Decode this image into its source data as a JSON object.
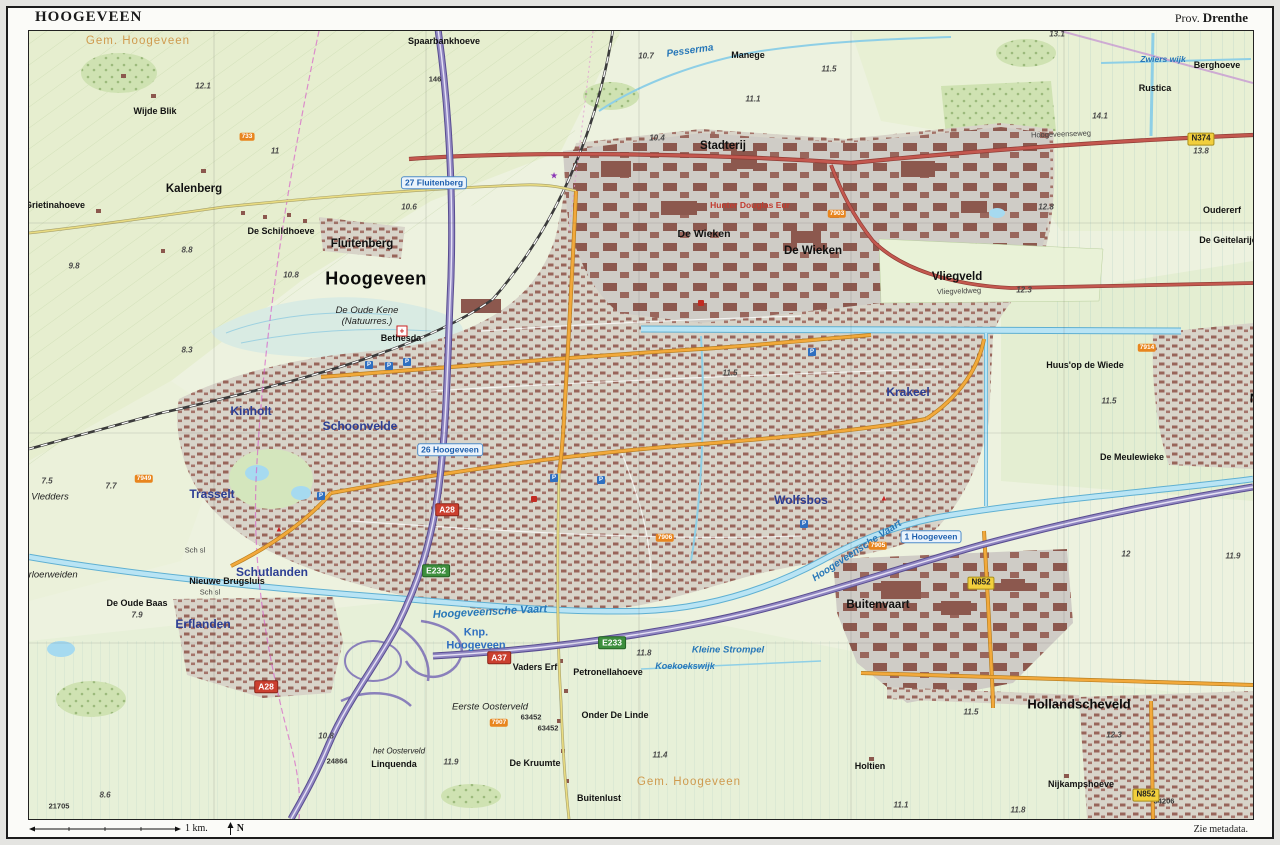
{
  "header": {
    "title": "HOOGEVEEN",
    "province_prefix": "Prov.",
    "province": "Drenthe"
  },
  "footer": {
    "scale_label": "1 km.",
    "north_label": "N",
    "metadata_note": "Zie metadata."
  },
  "palette": {
    "field_green": "#edf2df",
    "forest_green": "#cfe2b2",
    "urban_base": "#d8d4c9",
    "building_red": "#98655a",
    "motorway_purple": "#9187c2",
    "main_road_red": "#c4584f",
    "city_road_orange": "#f2a93b",
    "water_blue": "#b9e4f4",
    "district_blue": "#2c3e94",
    "municipality_orange": "#cf9a4e"
  },
  "map": {
    "labels": [
      {
        "text": "Gem. Hoogeveen",
        "type": "muni",
        "x": 137,
        "y": 40
      },
      {
        "text": "Gem. Hoogeveen",
        "type": "muni",
        "x": 688,
        "y": 781
      },
      {
        "text": "Hoogeveen",
        "type": "major",
        "x": 375,
        "y": 278,
        "name": "map-label-hoogeveen-city"
      },
      {
        "text": "Hollandscheveld",
        "type": "city2",
        "x": 1078,
        "y": 703
      },
      {
        "text": "Noordscheschut",
        "type": "city2",
        "x": 1300,
        "y": 397
      },
      {
        "text": "Fluitenberg",
        "type": "town",
        "x": 361,
        "y": 243
      },
      {
        "text": "Kalenberg",
        "type": "town",
        "x": 193,
        "y": 188
      },
      {
        "text": "Stadterij",
        "type": "town",
        "x": 722,
        "y": 145
      },
      {
        "text": "De Wieken",
        "type": "town",
        "x": 703,
        "y": 233,
        "size": 10.5
      },
      {
        "text": "De Wieken",
        "type": "town",
        "x": 812,
        "y": 250
      },
      {
        "text": "Vliegveld",
        "type": "town",
        "x": 956,
        "y": 276
      },
      {
        "text": "Buitenvaart",
        "type": "town",
        "x": 877,
        "y": 604
      },
      {
        "text": "Wijde Blik",
        "type": "hamlet",
        "x": 154,
        "y": 110
      },
      {
        "text": "Grietinahoeve",
        "type": "hamlet",
        "x": 54,
        "y": 204
      },
      {
        "text": "De Schildhoeve",
        "type": "hamlet",
        "x": 280,
        "y": 230
      },
      {
        "text": "Spaarbankhoeve",
        "type": "hamlet",
        "x": 443,
        "y": 40
      },
      {
        "text": "Manege",
        "type": "hamlet",
        "x": 747,
        "y": 54
      },
      {
        "text": "Berghoeve",
        "type": "hamlet",
        "x": 1216,
        "y": 64
      },
      {
        "text": "Rustica",
        "type": "hamlet",
        "x": 1154,
        "y": 87
      },
      {
        "text": "Oudererf",
        "type": "hamlet",
        "x": 1221,
        "y": 209
      },
      {
        "text": "De Geitelarije",
        "type": "hamlet",
        "x": 1227,
        "y": 239
      },
      {
        "text": "Huus'op de Wiede",
        "type": "hamlet",
        "x": 1084,
        "y": 364
      },
      {
        "text": "De Meulewieke",
        "type": "hamlet",
        "x": 1131,
        "y": 456
      },
      {
        "text": "Nieuwe Brugsluis",
        "type": "hamlet",
        "x": 226,
        "y": 580
      },
      {
        "text": "De Oude Baas",
        "type": "hamlet",
        "x": 136,
        "y": 602
      },
      {
        "text": "Vaders Erf",
        "type": "hamlet",
        "x": 534,
        "y": 666
      },
      {
        "text": "Petronellahoeve",
        "type": "hamlet",
        "x": 607,
        "y": 671
      },
      {
        "text": "Onder De Linde",
        "type": "hamlet",
        "x": 614,
        "y": 714
      },
      {
        "text": "De Kruumte",
        "type": "hamlet",
        "x": 534,
        "y": 762
      },
      {
        "text": "Linquenda",
        "type": "hamlet",
        "x": 393,
        "y": 763
      },
      {
        "text": "Buitenlust",
        "type": "hamlet",
        "x": 598,
        "y": 797
      },
      {
        "text": "Nijkampshoeve",
        "type": "hamlet",
        "x": 1080,
        "y": 783
      },
      {
        "text": "Holtien",
        "type": "hamlet",
        "x": 869,
        "y": 765
      },
      {
        "text": "Bethesda",
        "type": "hamlet",
        "x": 400,
        "y": 337
      },
      {
        "text": "Hunter Douglas Eur",
        "type": "company",
        "x": 749,
        "y": 204
      },
      {
        "text": "Krakeel",
        "type": "district",
        "x": 907,
        "y": 391
      },
      {
        "text": "Wolfsbos",
        "type": "district",
        "x": 800,
        "y": 499
      },
      {
        "text": "Kinholt",
        "type": "district",
        "x": 250,
        "y": 410
      },
      {
        "text": "Schoonvelde",
        "type": "district",
        "x": 359,
        "y": 425
      },
      {
        "text": "Trasselt",
        "type": "district",
        "x": 211,
        "y": 493
      },
      {
        "text": "Schutlanden",
        "type": "district",
        "x": 271,
        "y": 571
      },
      {
        "text": "Erflanden",
        "type": "district",
        "x": 202,
        "y": 623
      },
      {
        "lines": [
          "De Oude Kene",
          "(Natuurres.)"
        ],
        "type": "nature",
        "x": 366,
        "y": 316,
        "name": "map-label-de-oude-kene"
      },
      {
        "text": "Vledders",
        "type": "nature",
        "x": 49,
        "y": 497
      },
      {
        "text": "Arloerweiden",
        "type": "nature",
        "x": 49,
        "y": 575
      },
      {
        "text": "Eerste Oosterveld",
        "type": "nature",
        "x": 489,
        "y": 707
      },
      {
        "text": "het Oosterveld",
        "type": "nature",
        "x": 398,
        "y": 750,
        "size": 8
      },
      {
        "lines": [
          "Knp.",
          "Hoogeveen"
        ],
        "type": "junction",
        "x": 475,
        "y": 638,
        "name": "map-label-knp-hoogeveen"
      },
      {
        "text": "Hoogeveensche Vaart",
        "type": "water",
        "x": 489,
        "y": 611,
        "rotate": -3
      },
      {
        "text": "Hoogeveensche Vaart",
        "type": "water",
        "x": 856,
        "y": 550,
        "rotate": -33,
        "size": 10
      },
      {
        "text": "Pesserma",
        "type": "water",
        "x": 689,
        "y": 50,
        "rotate": -8,
        "size": 10
      },
      {
        "text": "Kleine Strompel",
        "type": "water",
        "x": 727,
        "y": 649,
        "size": 9.5
      },
      {
        "text": "Koekoekswijk",
        "type": "water",
        "x": 684,
        "y": 665,
        "size": 9
      },
      {
        "text": "Zwiers wijk",
        "type": "water",
        "x": 1162,
        "y": 58,
        "size": 8.5
      },
      {
        "text": "Hoogeveenseweg",
        "type": "street",
        "x": 1060,
        "y": 133,
        "rotate": -2
      },
      {
        "text": "Vliegveldweg",
        "type": "street",
        "x": 958,
        "y": 290,
        "rotate": -2
      },
      {
        "text": "Sch sl",
        "type": "street",
        "x": 209,
        "y": 591
      },
      {
        "text": "Sch sl",
        "type": "street",
        "x": 194,
        "y": 549
      },
      {
        "text": "12.1",
        "type": "elev",
        "x": 202,
        "y": 85
      },
      {
        "text": "11",
        "type": "elev",
        "x": 274,
        "y": 150
      },
      {
        "text": "10.6",
        "type": "elev",
        "x": 408,
        "y": 206
      },
      {
        "text": "9.8",
        "type": "elev",
        "x": 73,
        "y": 265
      },
      {
        "text": "10.8",
        "type": "elev",
        "x": 290,
        "y": 274
      },
      {
        "text": "8.8",
        "type": "elev",
        "x": 186,
        "y": 249
      },
      {
        "text": "10.7",
        "type": "elev",
        "x": 645,
        "y": 55
      },
      {
        "text": "10.4",
        "type": "elev",
        "x": 656,
        "y": 137
      },
      {
        "text": "11.5",
        "type": "elev",
        "x": 828,
        "y": 68
      },
      {
        "text": "11.1",
        "type": "elev",
        "x": 752,
        "y": 98
      },
      {
        "text": "13.1",
        "type": "elev",
        "x": 1056,
        "y": 33
      },
      {
        "text": "14.1",
        "type": "elev",
        "x": 1099,
        "y": 115
      },
      {
        "text": "13.8",
        "type": "elev",
        "x": 1200,
        "y": 150
      },
      {
        "text": "12.8",
        "type": "elev",
        "x": 1045,
        "y": 206
      },
      {
        "text": "12.3",
        "type": "elev",
        "x": 1023,
        "y": 289
      },
      {
        "text": "11.5",
        "type": "elev",
        "x": 1108,
        "y": 400
      },
      {
        "text": "11.5",
        "type": "elev",
        "x": 729,
        "y": 372
      },
      {
        "text": "7.5",
        "type": "elev",
        "x": 46,
        "y": 480
      },
      {
        "text": "7.7",
        "type": "elev",
        "x": 110,
        "y": 485
      },
      {
        "text": "7.9",
        "type": "elev",
        "x": 136,
        "y": 614
      },
      {
        "text": "8.3",
        "type": "elev",
        "x": 186,
        "y": 349
      },
      {
        "text": "8.6",
        "type": "elev",
        "x": 104,
        "y": 794
      },
      {
        "text": "10.8",
        "type": "elev",
        "x": 325,
        "y": 735
      },
      {
        "text": "11.9",
        "type": "elev",
        "x": 450,
        "y": 761
      },
      {
        "text": "11.4",
        "type": "elev",
        "x": 659,
        "y": 754
      },
      {
        "text": "11.8",
        "type": "elev",
        "x": 643,
        "y": 652
      },
      {
        "text": "11.9",
        "type": "elev",
        "x": 1232,
        "y": 555
      },
      {
        "text": "12",
        "type": "elev",
        "x": 1125,
        "y": 553
      },
      {
        "text": "12.3",
        "type": "elev",
        "x": 1113,
        "y": 734
      },
      {
        "text": "11.5",
        "type": "elev",
        "x": 970,
        "y": 711
      },
      {
        "text": "11.1",
        "type": "elev",
        "x": 900,
        "y": 804
      },
      {
        "text": "11.8",
        "type": "elev",
        "x": 1017,
        "y": 809
      },
      {
        "text": "21705",
        "type": "ref",
        "x": 58,
        "y": 805
      },
      {
        "text": "24864",
        "type": "ref",
        "x": 336,
        "y": 760
      },
      {
        "text": "34206",
        "type": "ref",
        "x": 1163,
        "y": 800
      },
      {
        "text": "63452",
        "type": "ref",
        "x": 530,
        "y": 716
      },
      {
        "text": "63452",
        "type": "ref",
        "x": 547,
        "y": 727
      },
      {
        "text": "146",
        "type": "ref",
        "x": 434,
        "y": 78
      }
    ],
    "shields": [
      {
        "kind": "motorway",
        "text": "A28",
        "x": 446,
        "y": 509
      },
      {
        "kind": "motorway",
        "text": "A28",
        "x": 265,
        "y": 686
      },
      {
        "kind": "motorway",
        "text": "A37",
        "x": 498,
        "y": 657
      },
      {
        "kind": "eroad",
        "text": "E232",
        "x": 435,
        "y": 570
      },
      {
        "kind": "eroad",
        "text": "E233",
        "x": 611,
        "y": 642
      },
      {
        "kind": "nroad",
        "text": "N374",
        "x": 1200,
        "y": 138
      },
      {
        "kind": "nroad",
        "text": "N852",
        "x": 980,
        "y": 582
      },
      {
        "kind": "nroad",
        "text": "N852",
        "x": 1145,
        "y": 794
      },
      {
        "kind": "local",
        "text": "733",
        "x": 246,
        "y": 136
      },
      {
        "kind": "local",
        "text": "7903",
        "x": 836,
        "y": 213
      },
      {
        "kind": "local",
        "text": "7905",
        "x": 877,
        "y": 545
      },
      {
        "kind": "local",
        "text": "7906",
        "x": 664,
        "y": 537
      },
      {
        "kind": "local",
        "text": "7907",
        "x": 498,
        "y": 722
      },
      {
        "kind": "local",
        "text": "7949",
        "x": 143,
        "y": 478
      },
      {
        "kind": "local",
        "text": "7914",
        "x": 1146,
        "y": 347
      },
      {
        "kind": "exit",
        "text": "27 Fluitenberg",
        "x": 433,
        "y": 182
      },
      {
        "kind": "exit",
        "text": "26 Hoogeveen",
        "x": 449,
        "y": 449
      },
      {
        "kind": "exit",
        "text": "1 Hoogeveen",
        "x": 930,
        "y": 536
      }
    ],
    "icons": [
      {
        "kind": "parking",
        "glyph": "P",
        "x": 368,
        "y": 364
      },
      {
        "kind": "parking",
        "glyph": "P",
        "x": 388,
        "y": 365
      },
      {
        "kind": "parking",
        "glyph": "P",
        "x": 406,
        "y": 361
      },
      {
        "kind": "parking",
        "glyph": "P",
        "x": 553,
        "y": 477
      },
      {
        "kind": "parking",
        "glyph": "P",
        "x": 600,
        "y": 479
      },
      {
        "kind": "parking",
        "glyph": "P",
        "x": 811,
        "y": 351
      },
      {
        "kind": "parking",
        "glyph": "P",
        "x": 803,
        "y": 523
      },
      {
        "kind": "parking",
        "glyph": "P",
        "x": 320,
        "y": 495
      },
      {
        "kind": "hospital",
        "glyph": "+",
        "x": 401,
        "y": 330
      },
      {
        "kind": "museum",
        "glyph": "★",
        "x": 553,
        "y": 175
      },
      {
        "kind": "camping",
        "glyph": "▲",
        "x": 278,
        "y": 528
      },
      {
        "kind": "camping",
        "glyph": "▲",
        "x": 883,
        "y": 497
      },
      {
        "kind": "poi",
        "glyph": "",
        "x": 533,
        "y": 498
      },
      {
        "kind": "poi",
        "glyph": "",
        "x": 700,
        "y": 302
      }
    ]
  }
}
